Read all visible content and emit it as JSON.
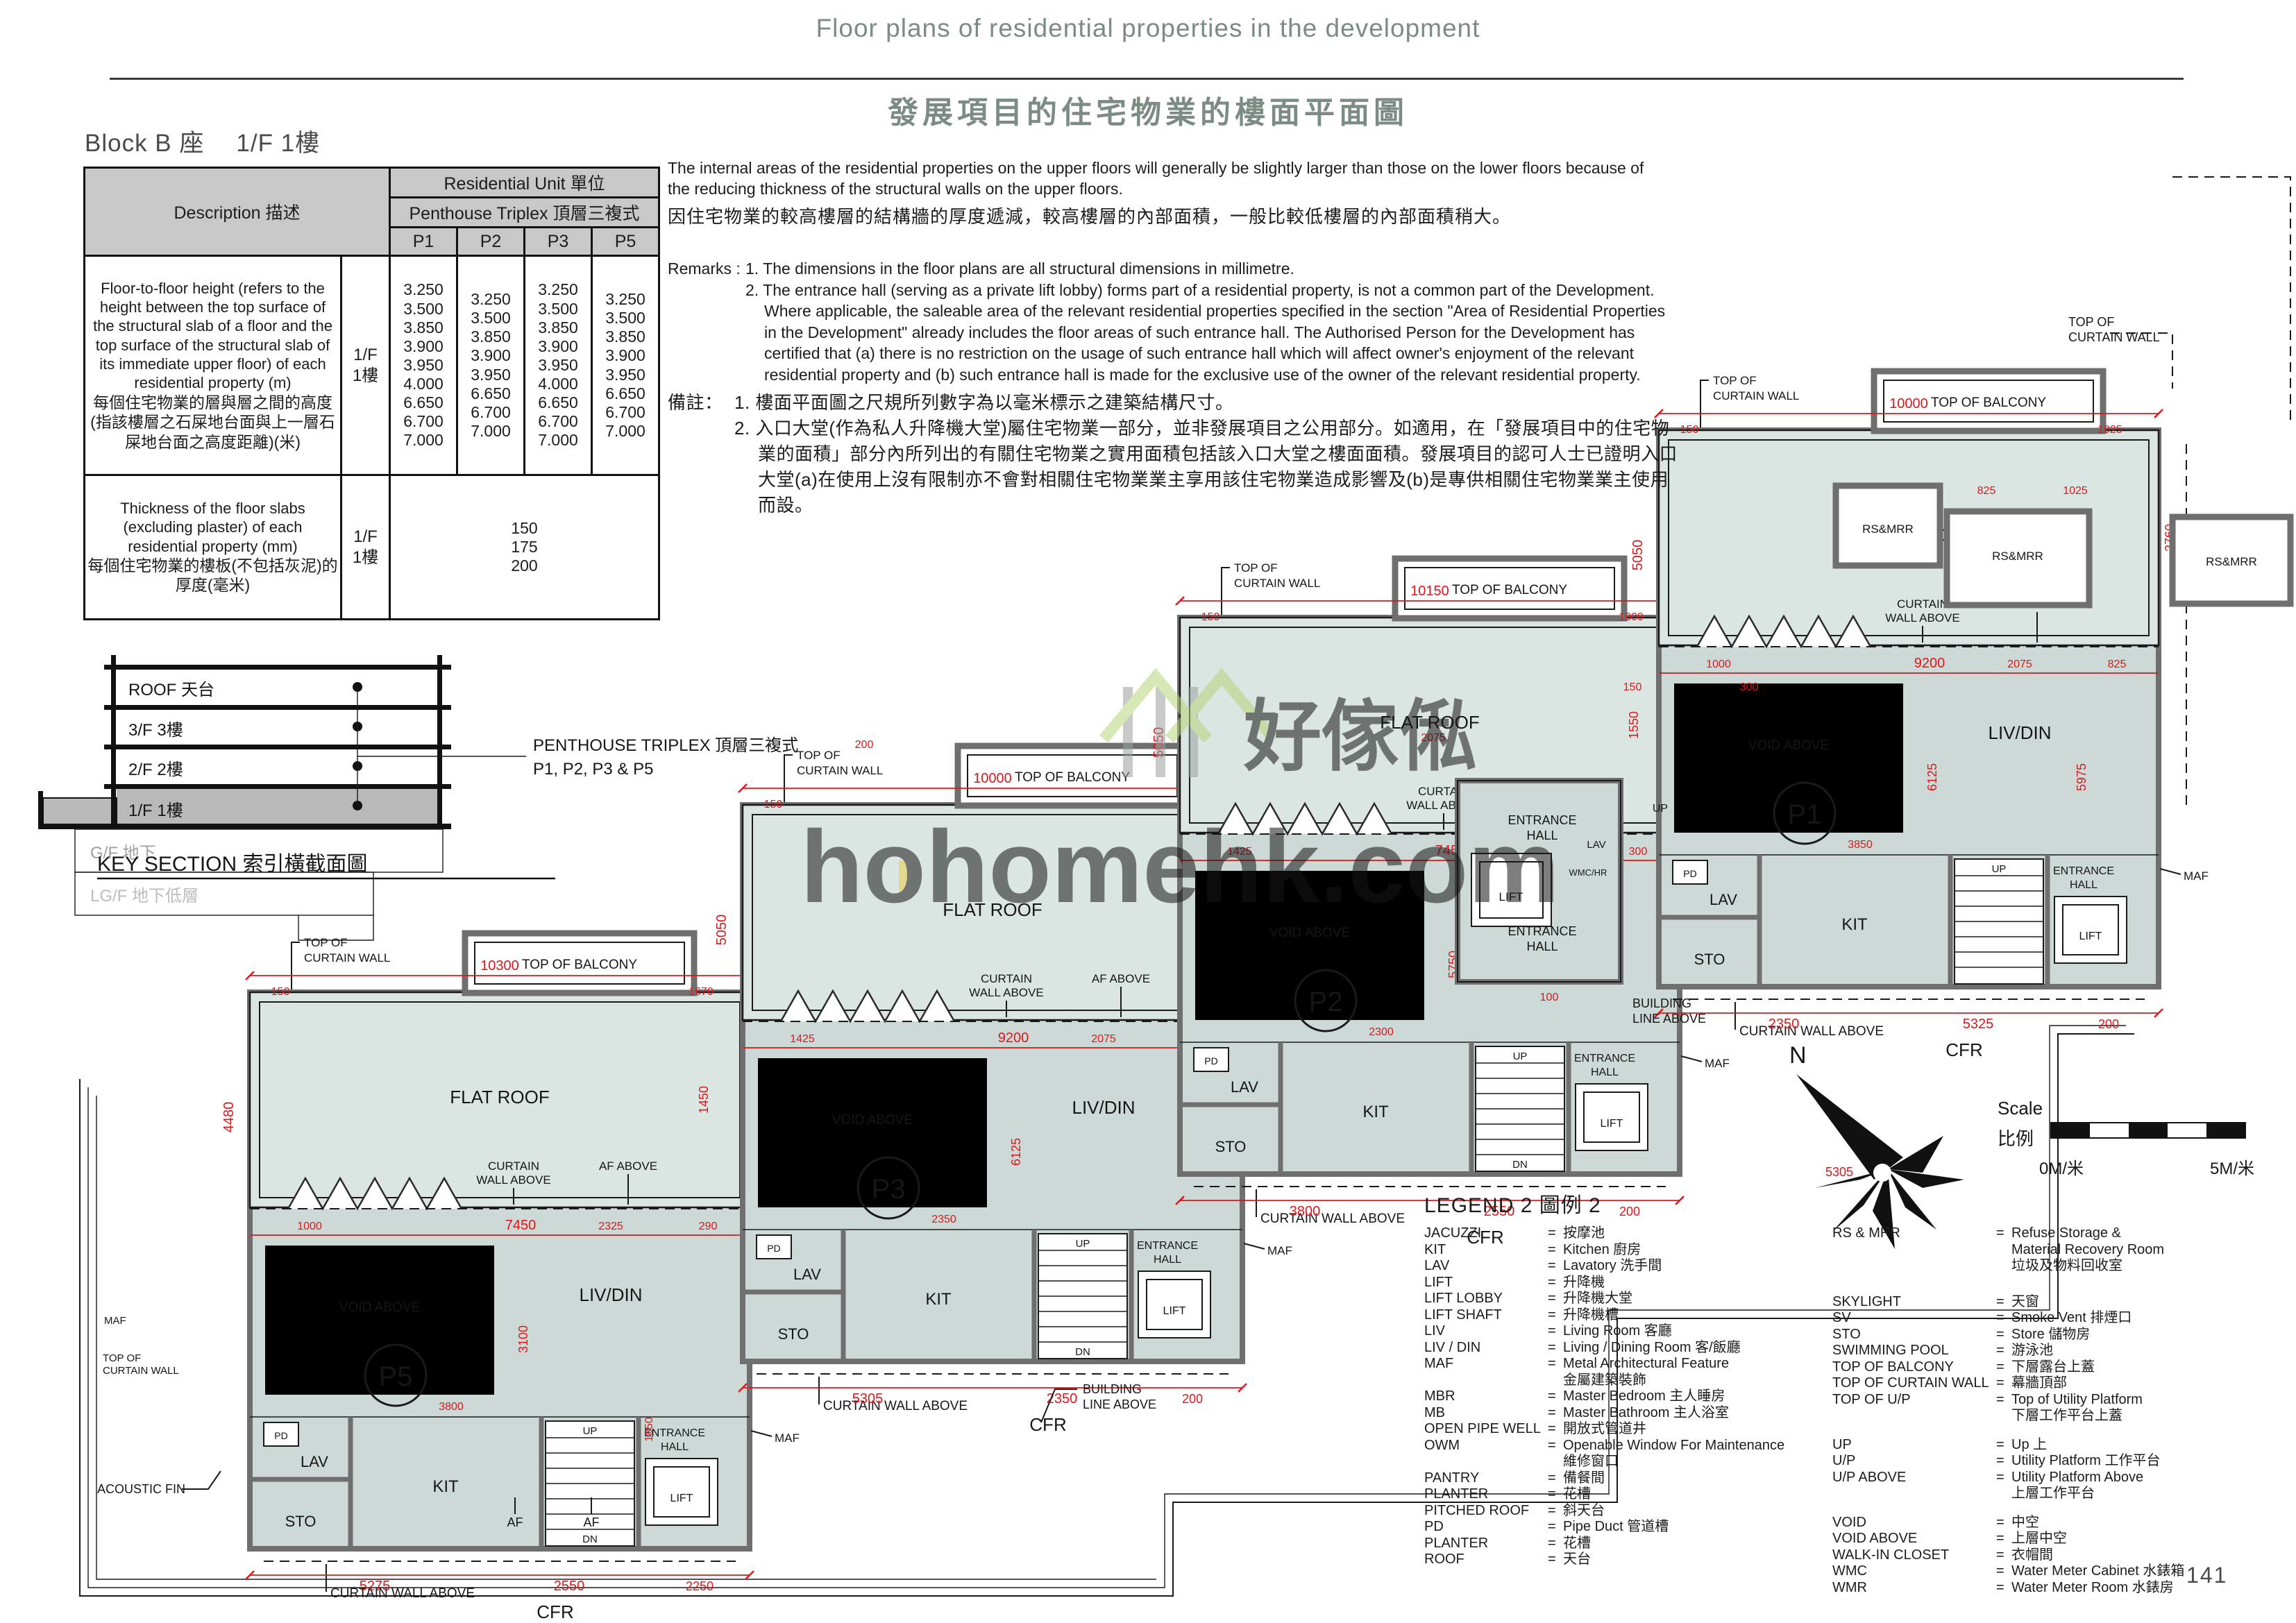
{
  "header": {
    "title_en": "Floor plans of residential properties in the development",
    "title_zh": "發展項目的住宅物業的樓面平面圖"
  },
  "block": {
    "name": "Block B 座",
    "floor": "1/F 1樓"
  },
  "table": {
    "desc_header": "Description 描述",
    "unit_header": "Residential Unit 單位",
    "type_header": "Penthouse Triplex 頂層三複式",
    "columns": [
      "P1",
      "P2",
      "P3",
      "P5"
    ],
    "rows": [
      {
        "desc_en": "Floor-to-floor height (refers to the height between the top surface of the structural slab of a floor and the top surface of the structural slab of its immediate upper floor) of each residential property (m)",
        "desc_zh": "每個住宅物業的層與層之間的高度(指該樓層之石屎地台面與上一層石屎地台面之高度距離)(米)",
        "floor": "1/F\n1樓",
        "values": [
          "3.250\n3.500\n3.850\n3.900\n3.950\n4.000\n6.650\n6.700\n7.000",
          "3.250\n3.500\n3.850\n3.900\n3.950\n6.650\n6.700\n7.000",
          "3.250\n3.500\n3.850\n3.900\n3.950\n4.000\n6.650\n6.700\n7.000",
          "3.250\n3.500\n3.850\n3.900\n3.950\n6.650\n6.700\n7.000"
        ]
      },
      {
        "desc_en": "Thickness of the floor slabs (excluding plaster) of each residential property (mm)",
        "desc_zh": "每個住宅物業的樓板(不包括灰泥)的厚度(毫米)",
        "floor": "1/F\n1樓",
        "value": "150\n175\n200"
      }
    ]
  },
  "intro": {
    "en": "The internal areas of the residential properties on the upper floors will generally be slightly larger than those on the lower floors because of the reducing thickness of the structural walls on the upper floors.",
    "zh": "因住宅物業的較高樓層的結構牆的厚度遞減，較高樓層的內部面積，一般比較低樓層的內部面積稍大。"
  },
  "remarks": {
    "label": "Remarks :",
    "items": [
      "1. The dimensions in the floor plans are all structural dimensions in millimetre.",
      "2. The entrance hall (serving as a private lift lobby) forms part of a residential property, is not a common part of the Development. Where applicable, the saleable area of the relevant residential properties specified in the section \"Area of Residential Properties in the Development\" already includes the floor areas of such entrance hall. The Authorised Person for the Development has certified that (a) there is no restriction on the usage of such entrance hall which will affect owner's enjoyment of the relevant residential property and (b) such entrance hall is made for the exclusive use of the owner of the relevant residential property."
    ]
  },
  "remarks_zh": {
    "label": "備註：",
    "items": [
      "1. 樓面平面圖之尺規所列數字為以毫米標示之建築結構尺寸。",
      "2. 入口大堂(作為私人升降機大堂)屬住宅物業一部分，並非發展項目之公用部分。如適用，在「發展項目中的住宅物業的面積」部分內所列出的有關住宅物業之實用面積包括該入口大堂之樓面面積。發展項目的認可人士已證明入口大堂(a)在使用上沒有限制亦不會對相關住宅物業業主享用該住宅物業造成影響及(b)是專供相關住宅物業業主使用而設。"
    ]
  },
  "key_section": {
    "title": "KEY SECTION 索引橫截面圖",
    "floors": [
      "ROOF 天台",
      "3/F 3樓",
      "2/F 2樓",
      "1/F 1樓"
    ],
    "below": [
      "G/F 地下",
      "LG/F 地下低層"
    ],
    "callout1": "PENTHOUSE TRIPLEX 頂層三複式",
    "callout2": "P1, P2, P3 & P5"
  },
  "compass": {
    "label": "N"
  },
  "scale": {
    "en": "Scale",
    "zh": "比例",
    "from": "0M/米",
    "to": "5M/米"
  },
  "watermark": {
    "zh": "好傢俬",
    "en": "hohomehk.com"
  },
  "page_number": "141",
  "legend": {
    "title": "LEGEND 2 圖例 2",
    "left": [
      {
        "abbr": "JACUZZI",
        "def": "按摩池"
      },
      {
        "abbr": "KIT",
        "def": "Kitchen 廚房"
      },
      {
        "abbr": "LAV",
        "def": "Lavatory 洗手間"
      },
      {
        "abbr": "LIFT",
        "def": "升降機"
      },
      {
        "abbr": "LIFT LOBBY",
        "def": "升降機大堂"
      },
      {
        "abbr": "LIFT SHAFT",
        "def": "升降機槽"
      },
      {
        "abbr": "LIV",
        "def": "Living Room 客廳"
      },
      {
        "abbr": "LIV / DIN",
        "def": "Living / Dining Room 客/飯廳"
      },
      {
        "abbr": "MAF",
        "def": "Metal Architectural Feature\n金屬建築裝飾"
      },
      {
        "abbr": "MBR",
        "def": "Master Bedroom 主人睡房"
      },
      {
        "abbr": "MB",
        "def": "Master Bathroom 主人浴室"
      },
      {
        "abbr": "OPEN PIPE WELL",
        "def": "開放式管道井"
      },
      {
        "abbr": "OWM",
        "def": "Openable Window For Maintenance\n維修窗口"
      },
      {
        "abbr": "PANTRY",
        "def": "備餐間"
      },
      {
        "abbr": "PLANTER",
        "def": "花槽"
      },
      {
        "abbr": "PITCHED ROOF",
        "def": "斜天台"
      },
      {
        "abbr": "PD",
        "def": "Pipe Duct 管道槽"
      },
      {
        "abbr": "PLANTER",
        "def": "花槽"
      },
      {
        "abbr": "ROOF",
        "def": "天台"
      }
    ],
    "right": [
      {
        "abbr": "RS & MRR",
        "def": "Refuse Storage &\nMaterial Recovery Room\n垃圾及物料回收室"
      },
      {
        "abbr": "SKYLIGHT",
        "def": "天窗"
      },
      {
        "abbr": "SV",
        "def": "Smoke Vent 排煙口"
      },
      {
        "abbr": "STO",
        "def": "Store 儲物房"
      },
      {
        "abbr": "SWIMMING POOL",
        "def": "游泳池"
      },
      {
        "abbr": "TOP OF BALCONY",
        "def": "下層露台上蓋"
      },
      {
        "abbr": "TOP OF CURTAIN WALL",
        "def": "幕牆頂部"
      },
      {
        "abbr": "TOP OF U/P",
        "def": "Top of Utility Platform\n下層工作平台上蓋"
      },
      {
        "abbr": "UP",
        "def": "Up 上"
      },
      {
        "abbr": "U/P",
        "def": "Utility Platform 工作平台"
      },
      {
        "abbr": "U/P ABOVE",
        "def": "Utility Platform Above\n上層工作平台"
      },
      {
        "abbr": "VOID",
        "def": "中空"
      },
      {
        "abbr": "VOID ABOVE",
        "def": "上層中空"
      },
      {
        "abbr": "WALK-IN CLOSET",
        "def": "衣帽間"
      },
      {
        "abbr": "WMC",
        "def": "Water Meter Cabinet 水錶箱"
      },
      {
        "abbr": "WMR",
        "def": "Water Meter Room 水錶房"
      }
    ]
  },
  "plan": {
    "room_labels": {
      "flat": "FLAT ROOF",
      "livdin": "LIV/DIN",
      "voidab": "VOID ABOVE",
      "kit": "KIT",
      "lav": "LAV",
      "sto": "STO",
      "pd": "PD",
      "lift": "LIFT",
      "ent1": "ENTRANCE",
      "ent2": "HALL",
      "up": "UP",
      "dn": "DN",
      "wmc": "WMC/HR",
      "cfr": "CFR",
      "rsmrr": "RS&MRR",
      "maf": "MAF",
      "af": "AF",
      "af_above": "AF ABOVE",
      "cw1": "CURTAIN",
      "cw2": "WALL ABOVE",
      "cw_single": "CURTAIN WALL ABOVE",
      "topcw1": "TOP OF",
      "topcw2": "CURTAIN WALL",
      "top_balcony": "TOP OF BALCONY",
      "bl1": "BUILDING",
      "bl2": "LINE ABOVE",
      "acoustic": "ACOUSTIC FIN"
    },
    "units": [
      {
        "id": "P1",
        "dims": {
          "top": "10000",
          "tsmall": "150",
          "left": "5050",
          "right": "2760",
          "mid": "9200",
          "msmall": "1000",
          "livh": "6125",
          "b1": "2350",
          "b2": "5325",
          "b3": "200",
          "x1": "1025",
          "x2": "825",
          "x3": "3850",
          "x4": "2075"
        }
      },
      {
        "id": "P2",
        "dims": {
          "top": "10150",
          "tsmall": "150",
          "left": "5050",
          "right": "1550",
          "mid": "7450",
          "msmall": "1425",
          "livh": "5750",
          "b1": "3800",
          "b2": "2550",
          "b3": "200",
          "x1": "1000",
          "x2": "300",
          "x3": "2300",
          "x4": "2575"
        }
      },
      {
        "id": "P3",
        "dims": {
          "top": "10000",
          "tsmall": "150",
          "left": "5050",
          "right": "1990",
          "mid": "9200",
          "msmall": "1425",
          "livh": "6125",
          "b1": "5305",
          "b2": "2350",
          "b3": "200",
          "x1": "1000",
          "x2": "300",
          "x3": "2350",
          "x4": "2075"
        }
      },
      {
        "id": "P5",
        "dims": {
          "top": "10300",
          "tsmall": "150",
          "left": "4480",
          "right": "1450",
          "mid": "7450",
          "msmall": "1000",
          "livh": "3100",
          "b1": "5275",
          "b2": "2550",
          "b3": "2250",
          "x1": "1670",
          "x2": "290",
          "x3": "3800",
          "x4": "2325"
        }
      }
    ],
    "extra_dims": [
      "5975",
      "5305",
      "825",
      "1025",
      "2075",
      "150",
      "300",
      "100",
      "200",
      "1850"
    ]
  }
}
